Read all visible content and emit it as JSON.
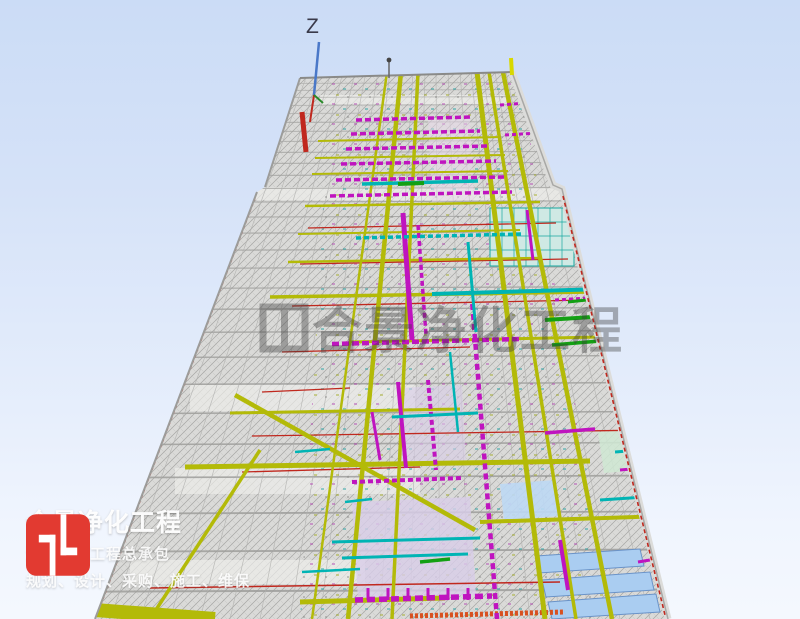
{
  "scene": {
    "axis_label": "Z",
    "watermark_text": "合景净化工程",
    "description": "3d-perspective-view-of-cleanroom-building-mep-model",
    "colors": {
      "background_top": "#cbdcf6",
      "background_bottom": "#f4f8fe",
      "roof_gray": "#d8d8d6",
      "pipe_yellow": "#b3ba08",
      "duct_magenta": "#bf14bf",
      "duct_cyan": "#00b4b4",
      "sprinkler_red": "#c0281e",
      "panel_blue": "#aacdf1",
      "tray_green": "#13a013",
      "band_orange": "#d85020",
      "axis_blue": "#4a78c8"
    }
  },
  "branding": {
    "logo_icon": "h-monogram",
    "logo_color": "#e23a31",
    "company_name": "合景净化工程",
    "tagline": "洁净车间工程总承包",
    "services": "规划、设计、采购、施工、维保"
  }
}
